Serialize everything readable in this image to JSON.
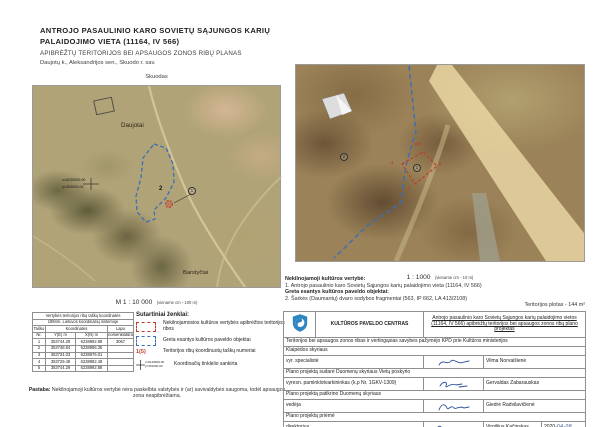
{
  "header": {
    "title_line1": "ANTROJO PASAULINIO KARO SOVIETŲ SĄJUNGOS KARIŲ",
    "title_line2": "PALAIDOJIMO VIETA (11164, IV 566)",
    "subtitle": "APIBRĖŽTŲ TERITORIJOS BEI APSAUGOS ZONOS RIBŲ PLANAS",
    "location": "Daujotų k., Aleksandrijos sen., Skuodo r. sav.",
    "town_label": "Skuodas"
  },
  "overview_map": {
    "village_label": "Daujotai",
    "town_label": "Barstyčiai",
    "grid_x": "x=6239000.00",
    "grid_y": "y=353000.00",
    "point2_label": "2",
    "point1_label": "1",
    "scale": "M 1 : 10 000",
    "scale_note": "(viename cm - 100 m)"
  },
  "detail_map": {
    "scale": "1 : 1000",
    "scale_note": "(viename cm - 10 m)",
    "object2_label": "2",
    "object1_label": "1",
    "point_labels": [
      "1(5)",
      "2",
      "3",
      "4"
    ]
  },
  "values": {
    "heading1": "Nekilnojamoji kultūros vertybė:",
    "item1": "1. Antrojo pasaulinio karo Sovietų Sąjungos karių palaidojimo vieta (11164, IV 566)",
    "heading2": "Greta esantys kultūros paveldo objektai:",
    "item2": "2. Šarkės (Daumantų) dvaro sodybos fragmentai (563, IP 662, LA 413/2108)",
    "area": "Teritorijos plotas - 144 m²"
  },
  "coord_table": {
    "title": "Vertybės teritorijos ribų taškų koordinatės",
    "subtitle": "1994m. Lietuvos koordinačių sistemoje",
    "col_point": "Taško",
    "col_point2": "Nr.",
    "col_coords": "Koordinatės",
    "col_y": "Y(E) m",
    "col_x": "X(N) m",
    "col_sheet": "Lapo",
    "col_sheet2": "nomenklatūra",
    "rows": [
      {
        "nr": "1",
        "y": "353744.29",
        "x": "6238992.88",
        "sheet": "3067"
      },
      {
        "nr": "2",
        "y": "353748.84",
        "x": "6238986.36",
        "sheet": ""
      },
      {
        "nr": "3",
        "y": "353734.03",
        "x": "6238976.01",
        "sheet": ""
      },
      {
        "nr": "4",
        "y": "353729.48",
        "x": "6238982.48",
        "sheet": ""
      },
      {
        "nr": "5",
        "y": "353744.29",
        "x": "6238992.88",
        "sheet": ""
      }
    ]
  },
  "legend": {
    "title": "Sutartiniai ženklai:",
    "item1": "Nekilnojamosios kultūros vertybės apibrėžtos teritorijos ribos",
    "item2": "Greta esantys kultūros paveldo objektai",
    "item3_label": "1(5)",
    "item3": "Teritorijos ribų koordinuotų taškų numeriai",
    "item4_x": "x=6129600.00",
    "item4_y": "y=391000.00",
    "item4": "Koordinačių tinklelio sankirta"
  },
  "note": {
    "label": "Pastaba:",
    "text": "Nekilnojamoji kultūros vertybė nėra paskelbta valstybės ir (ar) savivaldybės saugoma, todėl apsaugos zona neapibrėžiama."
  },
  "approval": {
    "org": "KULTŪROS PAVELDO CENTRAS",
    "project": "Antrojo pasaulinio karo Sovietų Sąjungos karių palaidojimo vietos (11164, IV 566) apibrėžtų teritorijos bei apsaugos zonos ribų plano projektas",
    "row1": "Teritorijos bei apsaugos zonos ribas ir vertingąsias savybes pažymėjo KPD prie Kultūros ministerijos",
    "row2": "Klaipėdos skyriaus",
    "role1": "vyr. specialistė",
    "name1": "Vilma Norvaišienė",
    "row3": "Plano projektą sudarė Duomenų skyriaus Vietų poskyrio",
    "role2": "vyresn. paminklotvarkininkas (k.p Nr. 1GKV-1309)",
    "name2": "Gervaldas Zabarauskas",
    "row4": "Plano projektą patikrino Duomenų skyriaus",
    "role3": "vedėja",
    "name3": "Giedrė Radvilavičienė",
    "row5": "Plano projektą priėmė",
    "role4": "direktorius",
    "name4": "Virgilijus Kačinskas",
    "date_year": "2020-",
    "date_md": "04-08"
  },
  "colors": {
    "boundary_red": "#c13a28",
    "boundary_blue": "#3a6fb5"
  }
}
